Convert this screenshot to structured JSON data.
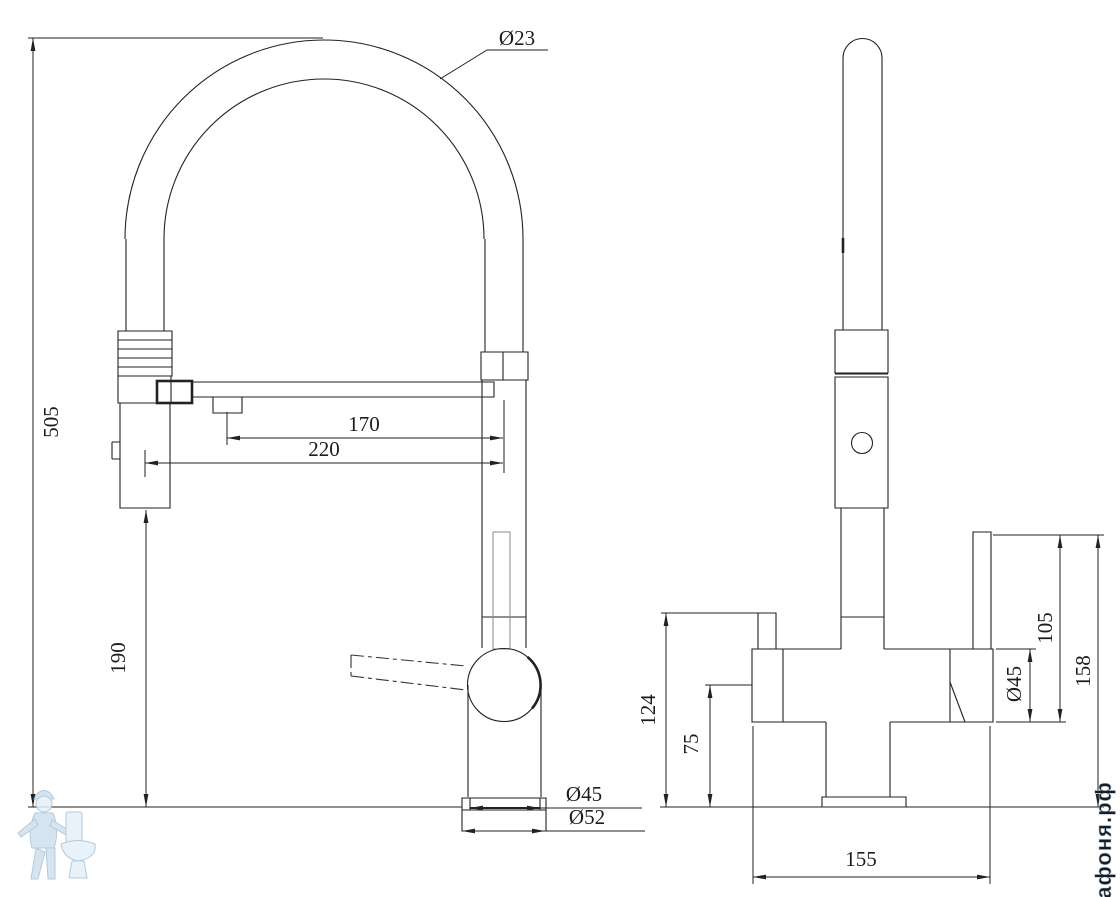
{
  "drawing": {
    "front_view": {
      "dims": {
        "hose_diameter": "Ø23",
        "overall_height": "505",
        "spout_reach": "170",
        "spray_head_offset": "220",
        "spray_head_clearance": "190",
        "base_top_diameter": "Ø45",
        "base_bottom_diameter": "Ø52"
      }
    },
    "side_view": {
      "dims": {
        "inlet_height": "124",
        "outlet_height": "75",
        "body_diameter": "Ø45",
        "handle_to_outlet": "105",
        "handle_to_deck": "158",
        "base_depth": "155"
      }
    },
    "watermark": {
      "site": "афоня.рф",
      "color": "#cfe0ee"
    }
  }
}
